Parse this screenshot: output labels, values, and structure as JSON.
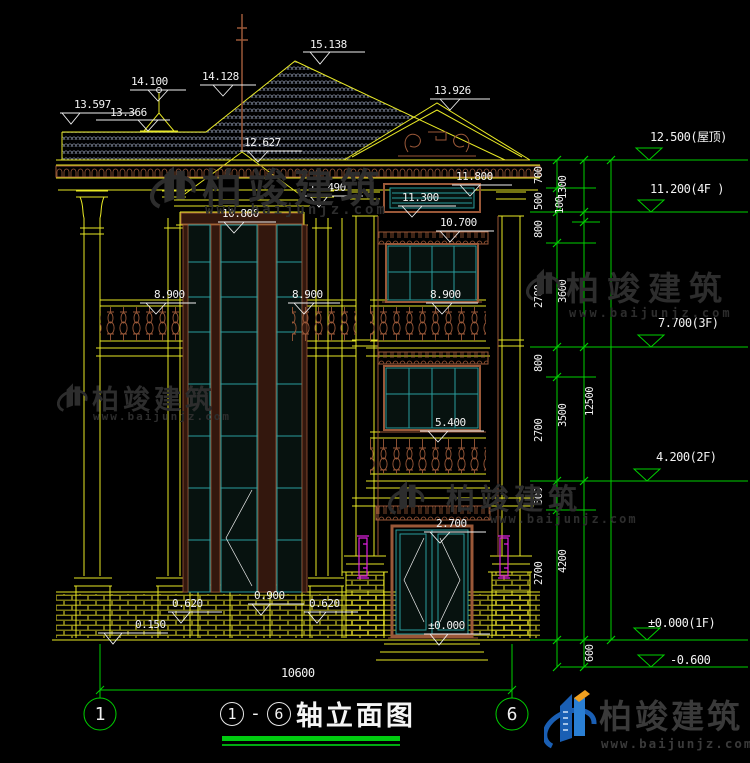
{
  "drawing": {
    "title": {
      "axis_start": "1",
      "dash": "-",
      "axis_end": "6",
      "name": "轴立面图"
    },
    "overall_width": "10600",
    "elevations": [
      "15.138",
      "14.100",
      "14.128",
      "13.926",
      "13.597",
      "13.366",
      "12.627",
      "11.800",
      "11.490",
      "11.300",
      "10.800",
      "10.700",
      "8.900",
      "8.900",
      "8.900",
      "5.400",
      "2.700",
      "0.620",
      "0.900",
      "0.620",
      "0.150",
      "±0.000"
    ],
    "levels": [
      "12.500(屋顶)",
      "11.200(4F )",
      "7.700(3F)",
      "4.200(2F)",
      "±0.000(1F)",
      "-0.600"
    ],
    "chain_col1": [
      "700",
      "500",
      "800",
      "2700",
      "800",
      "2700",
      "500",
      "2700"
    ],
    "chain_col2": [
      "1300",
      "100",
      "3600",
      "3500",
      "4200"
    ],
    "chain_col3": [
      "12500"
    ],
    "chain_base": "600",
    "axes": [
      "1",
      "6"
    ]
  },
  "watermark": {
    "brand": "柏竣建筑",
    "site": "www.baijunjz.com"
  },
  "logo": {
    "brand": "柏竣建筑",
    "site": "www.baijunjz.com"
  },
  "colors": {
    "line_yellow": "#e8e825",
    "dim_green": "#00d000",
    "trim_brown": "#9a5838",
    "glass_teal": "#2a9c9c",
    "accent_magenta": "#e020e0",
    "logo_blue": "#1a5fb4",
    "logo_orange": "#f0a020"
  }
}
